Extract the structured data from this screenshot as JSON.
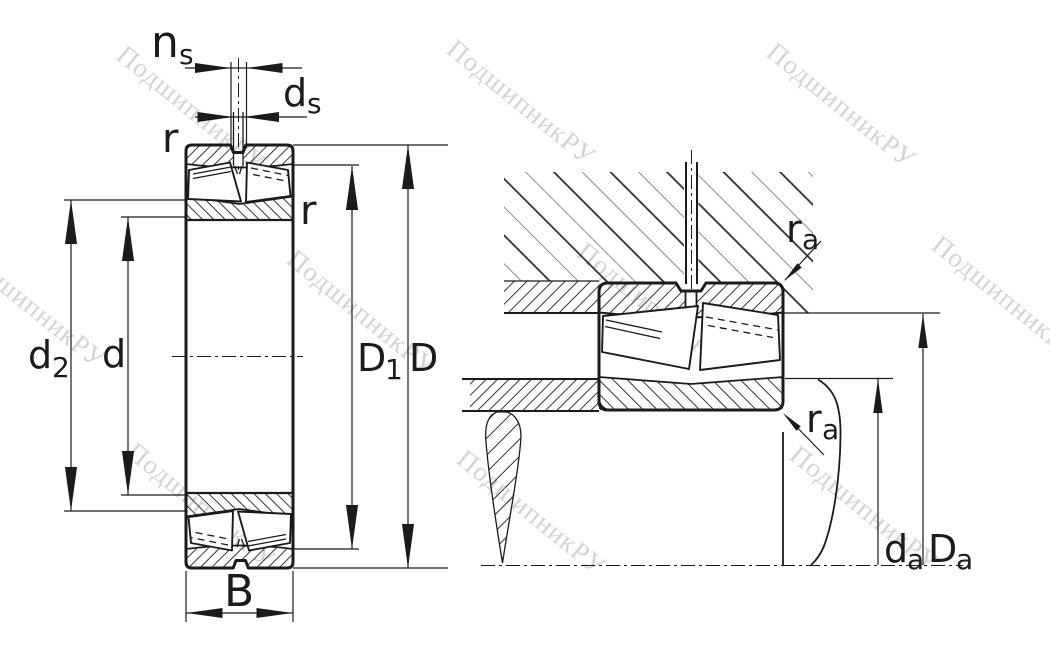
{
  "watermark": {
    "text": "ПодшипникРУ",
    "color": "#b0b0b0"
  },
  "colors": {
    "line": "#1b1b1b",
    "background": "#ffffff",
    "hatch_light": "#8c8c8c"
  },
  "left_view": {
    "labels": {
      "ns_main": "n",
      "ns_sub": "s",
      "ds_main": "d",
      "ds_sub": "s",
      "r_outer": "r",
      "r_inner": "r",
      "d2_main": "d",
      "d2_sub": "2",
      "d_main": "d",
      "D1_main": "D",
      "D1_sub": "1",
      "D_main": "D",
      "B_main": "B"
    }
  },
  "right_view": {
    "labels": {
      "ra_top_main": "r",
      "ra_top_sub": "a",
      "ra_bot_main": "r",
      "ra_bot_sub": "a",
      "da_main": "d",
      "da_sub": "a",
      "Da_main": "D",
      "Da_sub": "a"
    }
  }
}
